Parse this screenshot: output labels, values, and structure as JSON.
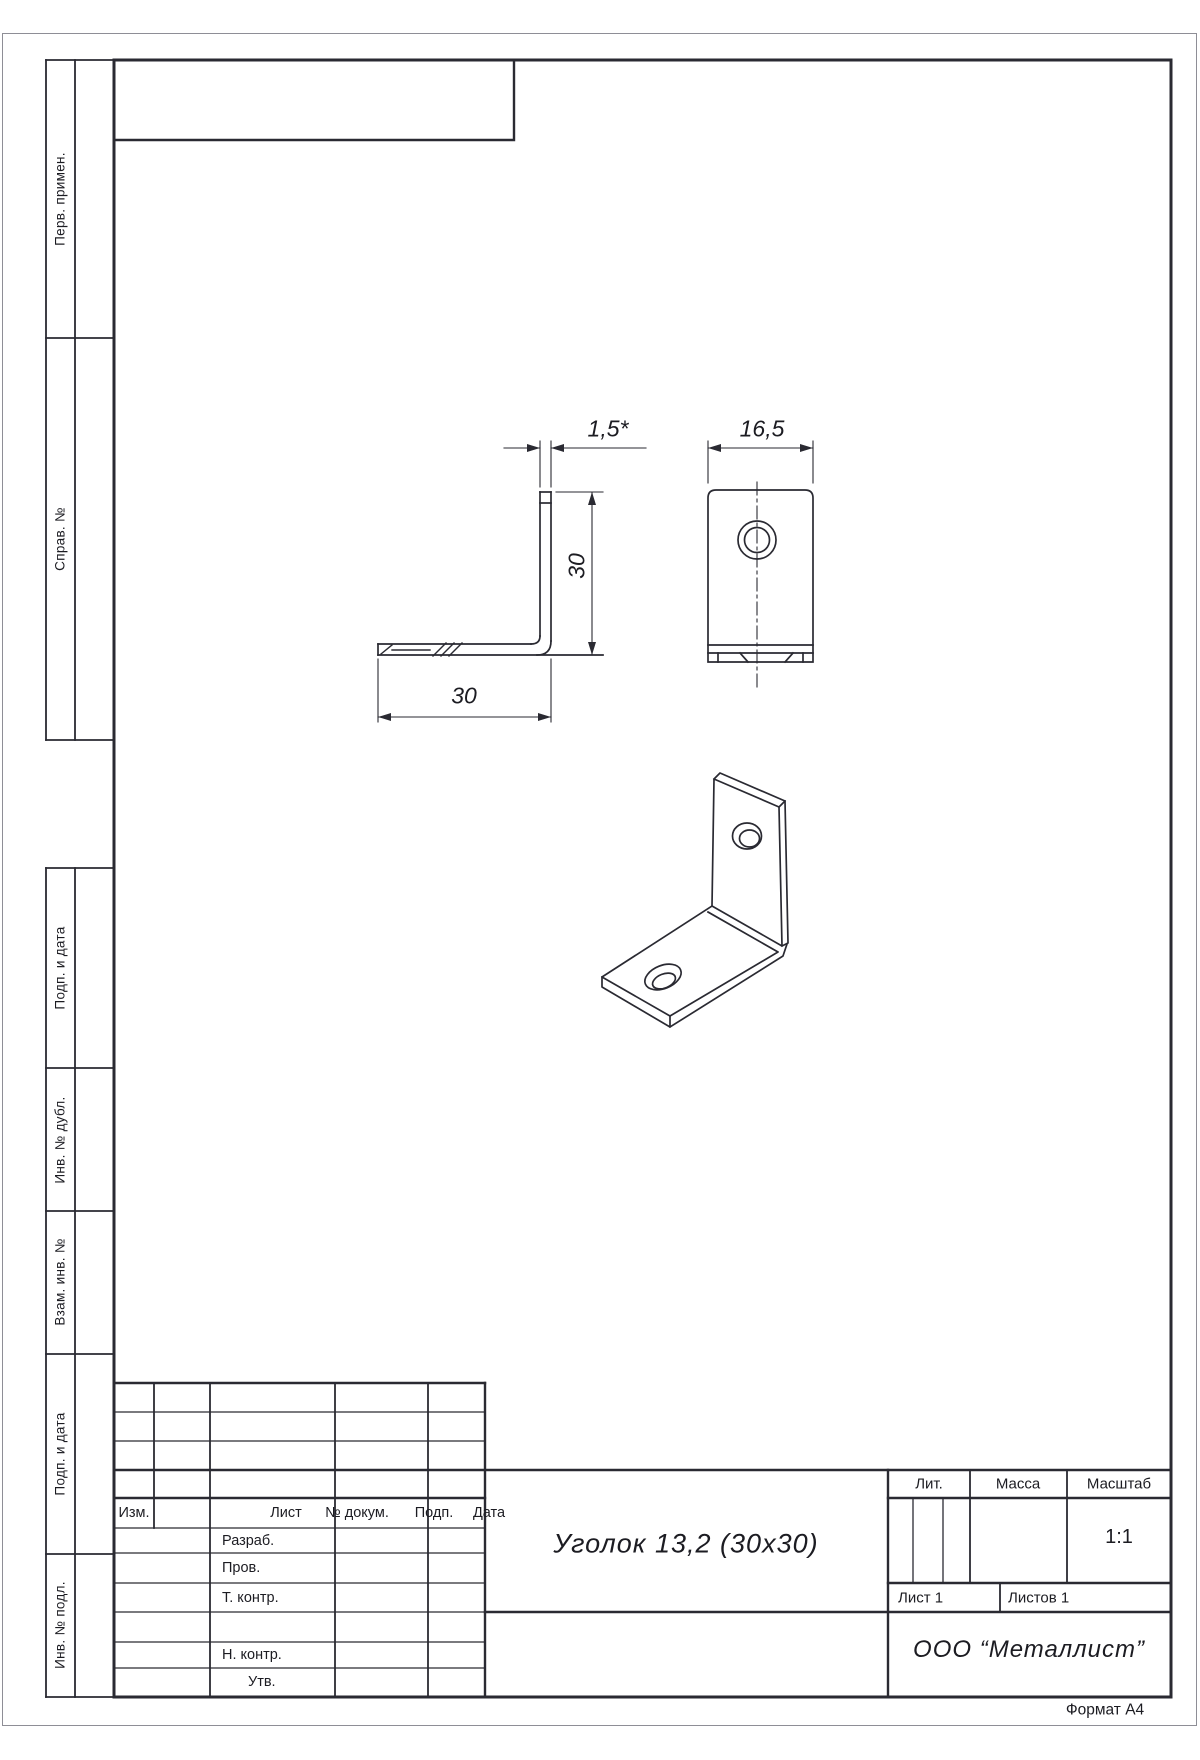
{
  "page": {
    "format_note": "Формат А4"
  },
  "left_margin": {
    "labels": [
      "Перв. примен.",
      "Справ. №",
      "Подп. и дата",
      "Инв. № дубл.",
      "Взам. инв. №",
      "Подп. и дата",
      "Инв. № подл."
    ]
  },
  "dimensions": {
    "thickness": "1,5*",
    "flange_width": "16,5",
    "height": "30",
    "length": "30"
  },
  "title_block": {
    "revision_header": [
      "Изм.",
      "Лист",
      "№ докум.",
      "Подп.",
      "Дата"
    ],
    "signature_rows": [
      "Разраб.",
      "Пров.",
      "Т. контр.",
      "",
      "Н. контр.",
      "Утв."
    ],
    "part_name": "Уголок 13,2 (30х30)",
    "literal_label": "Лит.",
    "mass_label": "Масса",
    "scale_label": "Масштаб",
    "scale_value": "1:1",
    "sheet": "Лист 1",
    "sheets_total": "Листов 1",
    "organization": "ООО “Металлист”"
  }
}
